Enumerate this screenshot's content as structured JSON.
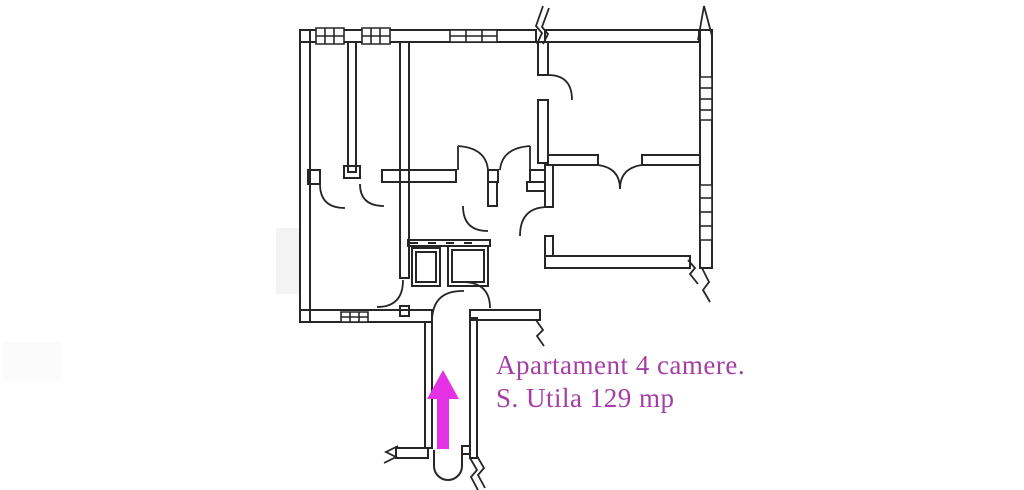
{
  "caption": {
    "line1": "Apartament 4 camere.",
    "line2": "S. Utila 129 mp"
  },
  "arrow": {
    "direction": "up"
  },
  "colors": {
    "caption_text": "#a43fa4",
    "arrow": "#e532e5",
    "wall_line": "#262626",
    "paper": "#ffffff",
    "scan_smudge": "#f3f3f3"
  }
}
